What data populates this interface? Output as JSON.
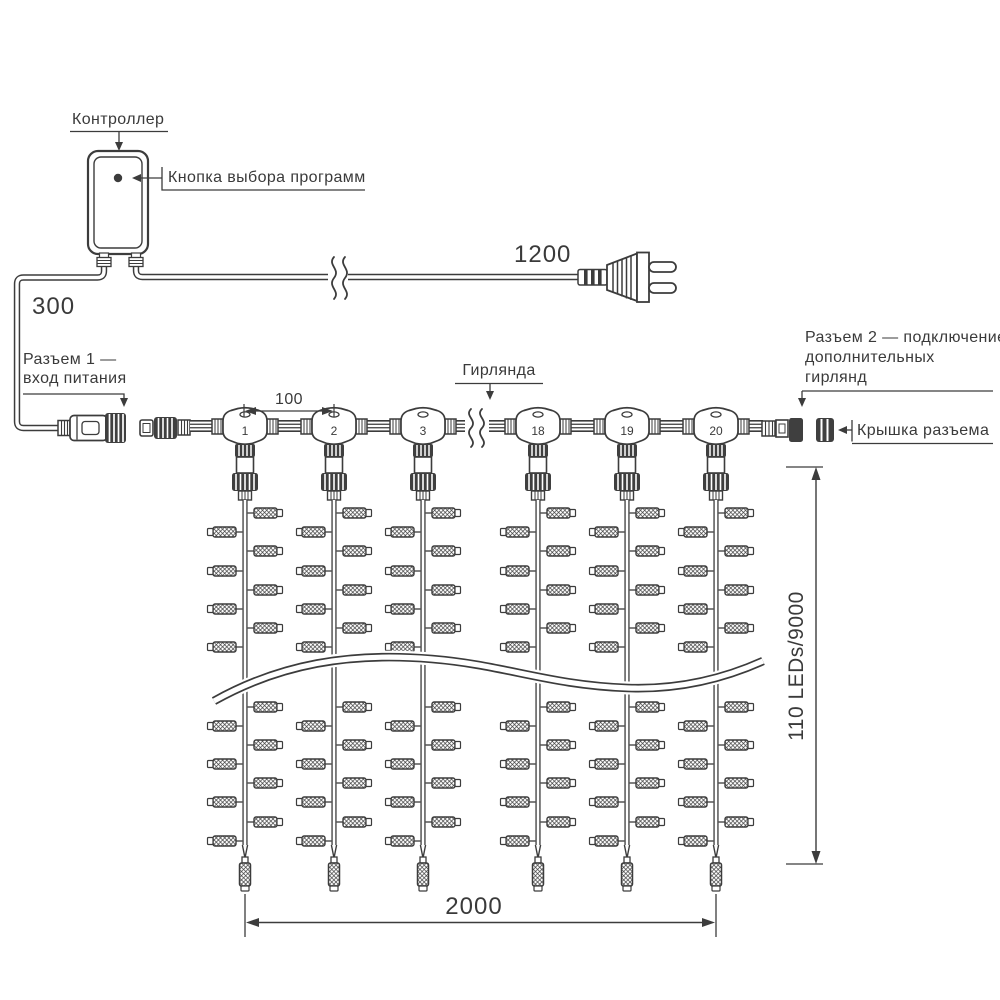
{
  "diagram": {
    "labels": {
      "controller": "Контроллер",
      "program_button": "Кнопка выбора программ",
      "connector1_line1": "Разъем 1 —",
      "connector1_line2": "вход питания",
      "garland": "Гирлянда",
      "connector2_line1": "Разъем 2 — подключение",
      "connector2_line2": "дополнительных",
      "connector2_line3": "гирлянд",
      "connector_cap": "Крышка разъема"
    },
    "dimensions": {
      "lead_in": "300",
      "power_cord": "1200",
      "drop_spacing": "100",
      "curtain_width": "2000",
      "curtain_height": "110 LEDs/9000"
    },
    "drop_numbers": [
      "1",
      "2",
      "3",
      "18",
      "19",
      "20"
    ],
    "colors": {
      "ink": "#3c3c3c",
      "dark_fill": "#3f3f3f",
      "background": "#ffffff"
    }
  }
}
